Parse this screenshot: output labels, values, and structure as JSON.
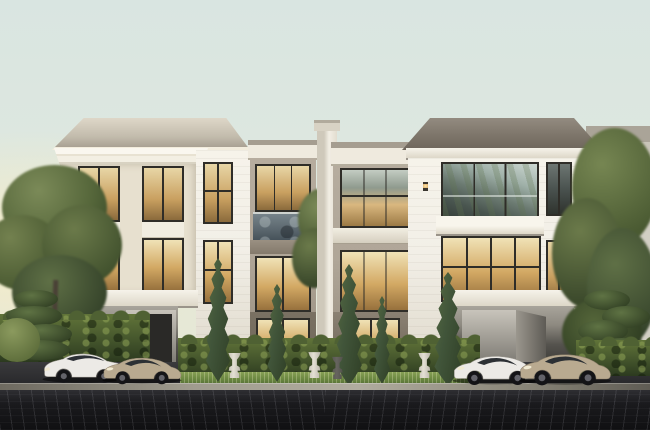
{
  "scene": {
    "description": "Dusk 3D architectural rendering of two symmetrical three-storey luxury townhomes: white classical front volumes with tall warm-lit windows and flared hip roofs, greige recessed middle units with stone balconies, a central white chimney pillar, carports each sheltering two sports cars (a white sedan and champagne coupe on the left, a white and a champagne sports car on the right), formal garden with tall cypress trees, scalloped hedges, classical planter urns, large green trees at both edges, and a dark herringbone paver driveway across the foreground under a pale green-blue sky with a warm glow on the left horizon.",
    "objects": {
      "sky": "pale green-blue dusk sky with warm left horizon glow",
      "left_house": "white three-storey villa with columned window bay and carport",
      "right_house": "white three-storey villa with dark hip roof, glazed balcony and carport",
      "middle_units": "greige recessed townhome units with stone balcony and two-storey glazing",
      "chimney": "central white chimney pillar",
      "cars": [
        "white luxury sedan",
        "champagne sports coupe",
        "white sports car",
        "champagne grand tourer"
      ],
      "landscape": [
        "large green tree left",
        "cypress trees",
        "boxwood hedges",
        "planter urns",
        "niwaki pines",
        "large green trees right"
      ],
      "ground": [
        "stone kerb",
        "dark paver driveway"
      ]
    }
  },
  "palette": {
    "sky_top": "#d9e5e1",
    "sky_mid": "#dfe8df",
    "sky_horizon": "#f0ead2",
    "sky_glow": "#f8edc4",
    "house_white": "#f2efe7",
    "house_white_dark": "#ded8ca",
    "trim_white": "#f6f3ea",
    "pilaster": "#e7e0cf",
    "greige": "#b0a698",
    "greige_dark": "#948a7c",
    "roof_dark_a": "#938b80",
    "roof_dark_b": "#6e665c",
    "roof_light_a": "#ded7c8",
    "roof_light_b": "#a9a193",
    "frame": "#2f2d28",
    "glass_warm_a": "#f0e2b6",
    "glass_warm_b": "#d3a964",
    "glass_warm_c": "#97713d",
    "glass_cool_a": "#bac7c3",
    "glass_cool_b": "#5c6862",
    "balustrade": "#5d6970",
    "stone": "#6e6557",
    "carport_a": "#a8a49b",
    "carport_b": "#383733",
    "tree_a": "#6e7f4f",
    "tree_b": "#3c4a2c",
    "cypress_a": "#5a6f44",
    "cypress_b": "#2e3d24",
    "hedge_a": "#5a6c3b",
    "hedge_b": "#2f3c22",
    "grass_a": "#87a055",
    "grass_b": "#4f6a33",
    "pave_a": "#2b2b2f",
    "pave_b": "#141416",
    "curb": "#8f8b7f",
    "car_white": "#eceae6",
    "car_champagne": "#b9aa90",
    "bg_build_a": "#aaa498",
    "bg_build_b": "#c9c5b9"
  }
}
